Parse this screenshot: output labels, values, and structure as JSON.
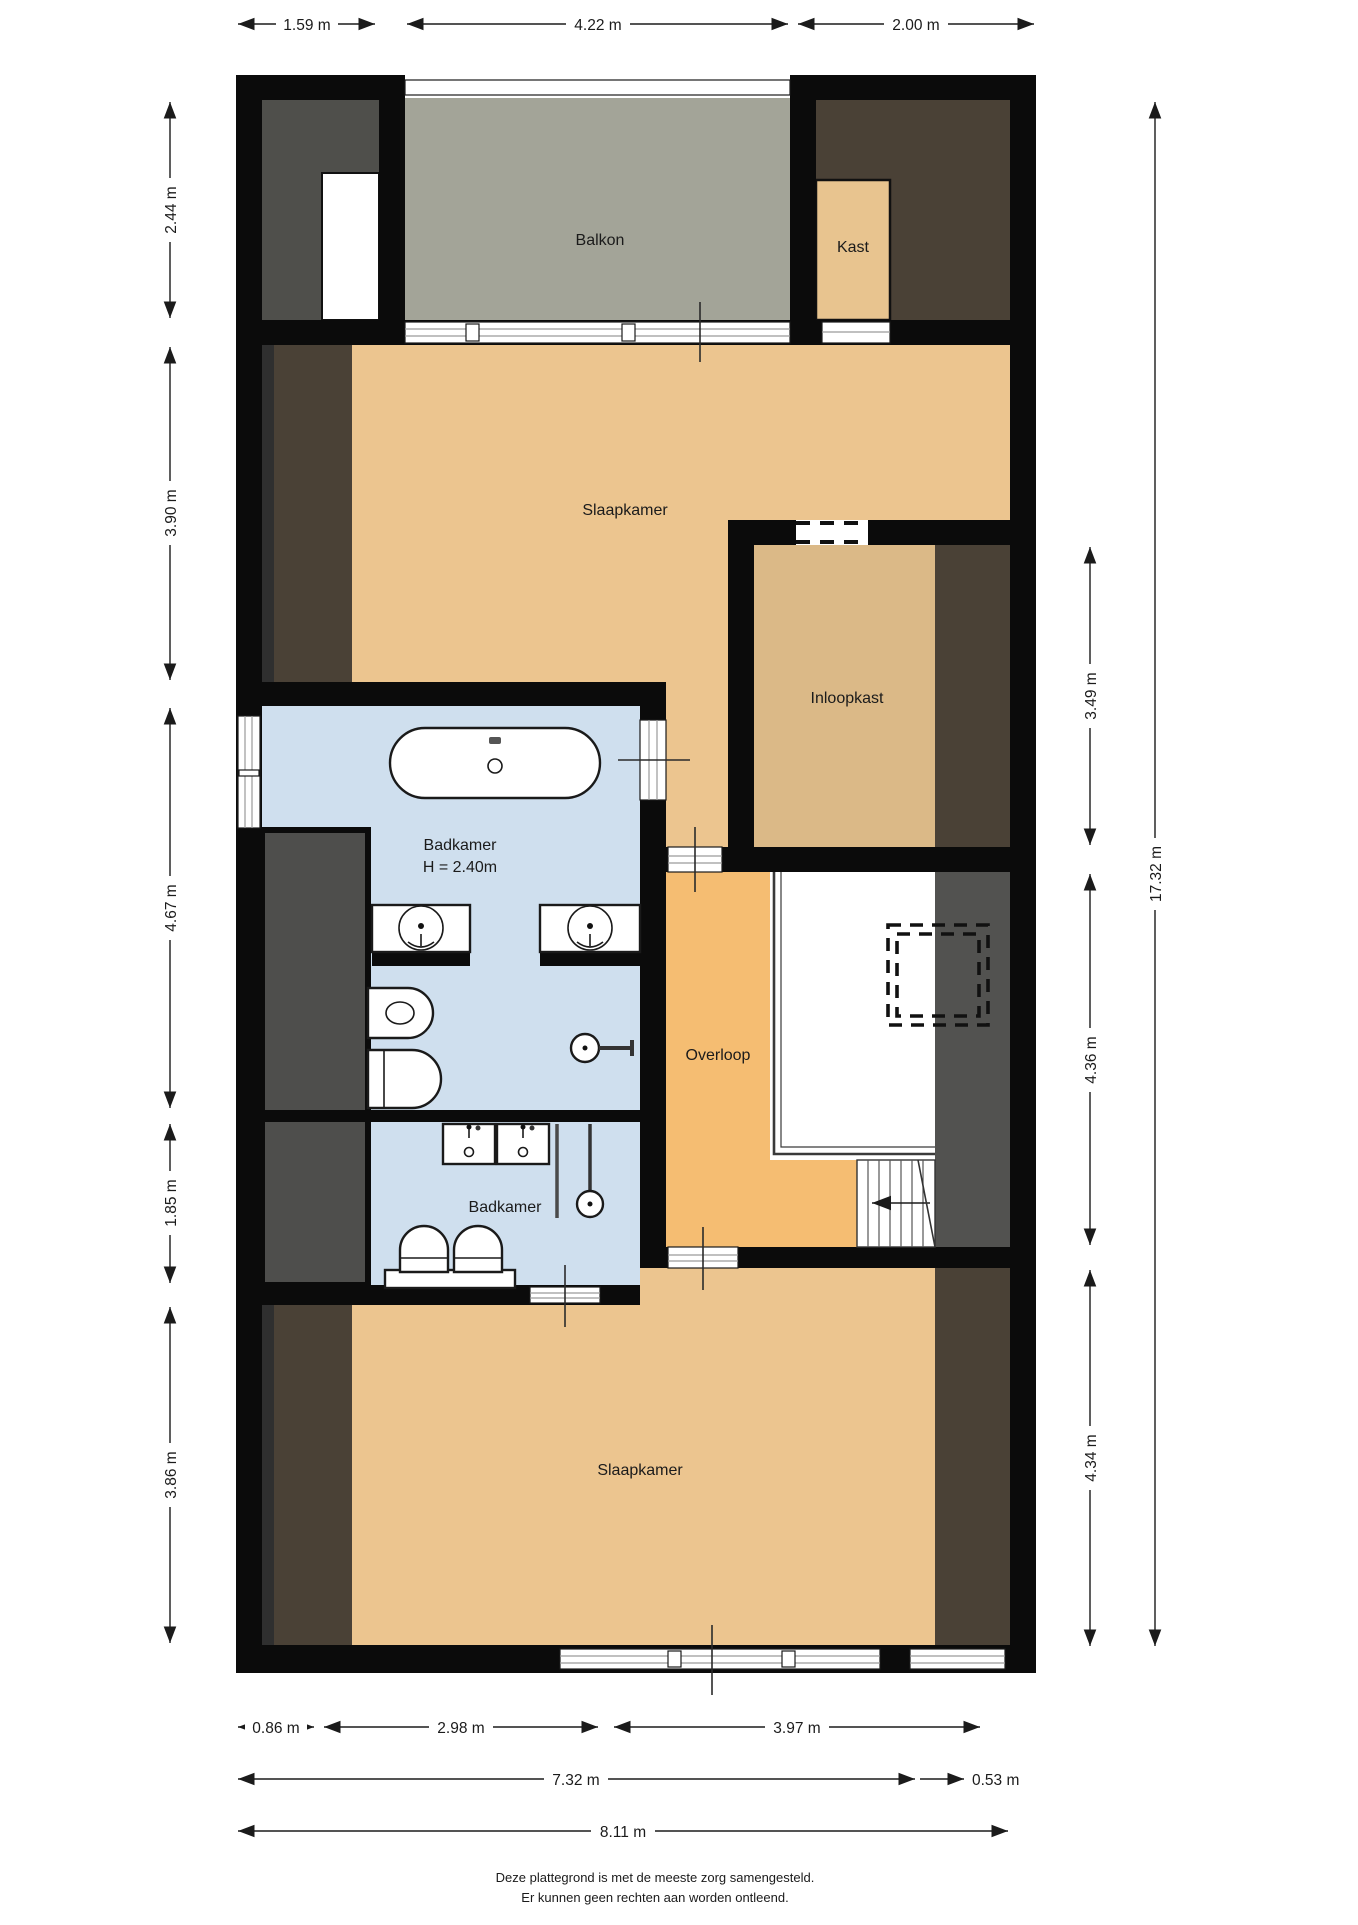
{
  "rooms": {
    "balkon": "Balkon",
    "kast": "Kast",
    "slaapkamer_top": "Slaapkamer",
    "inloopkast": "Inloopkast",
    "badkamer_main_label": "Badkamer",
    "badkamer_main_height": "H = 2.40m",
    "overloop": "Overloop",
    "badkamer_small": "Badkamer",
    "slaapkamer_bottom": "Slaapkamer"
  },
  "dimensions": {
    "top": [
      "1.59 m",
      "4.22 m",
      "2.00 m"
    ],
    "left": [
      "2.44 m",
      "3.90 m",
      "4.67 m",
      "1.85 m",
      "3.86 m"
    ],
    "right": [
      "3.49 m",
      "4.36 m",
      "4.34 m"
    ],
    "right_total": "17.32 m",
    "bottom_row1": [
      "0.86 m",
      "2.98 m",
      "3.97 m"
    ],
    "bottom_row2": [
      "7.32 m",
      "0.53 m"
    ],
    "bottom_row3": "8.11 m"
  },
  "footer": {
    "line1": "Deze plattegrond is met de meeste zorg samengesteld.",
    "line2": "Er kunnen geen rechten aan worden ontleend."
  },
  "colors": {
    "wall": "#0b0b0b",
    "floor_tan": "#ecc58f",
    "floor_inloopkast": "#dbb987",
    "floor_overloop": "#f5bd72",
    "floor_kast": "#e8c48f",
    "floor_balkon": "#a3a498",
    "floor_bathroom": "#cfdfee",
    "roof_brown": "#4a4136",
    "roof_gray": "#4f4f4b",
    "roof_gray2": "#525250",
    "void_white": "#ffffff"
  }
}
